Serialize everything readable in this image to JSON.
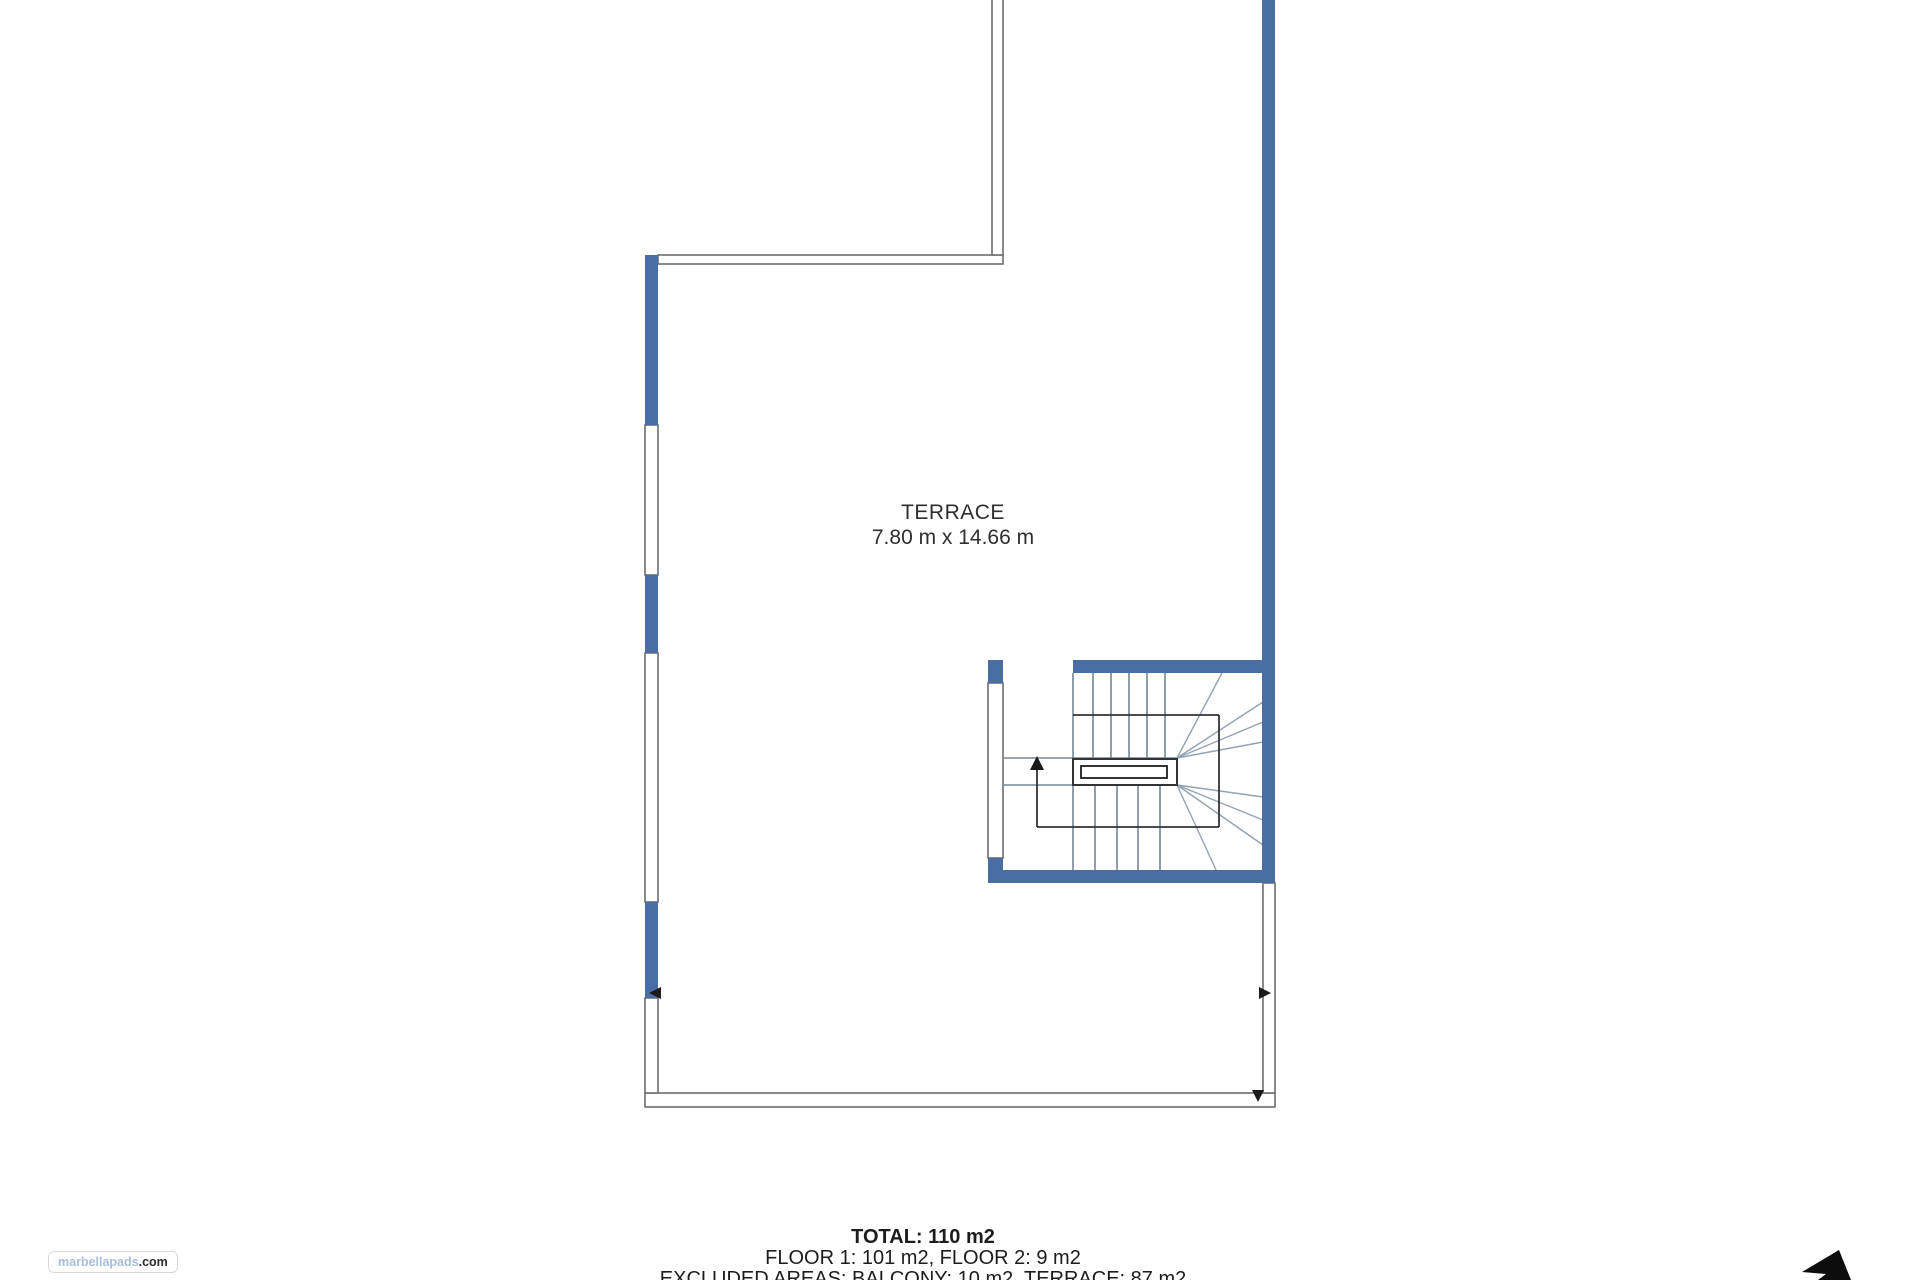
{
  "page": {
    "width": 1920,
    "height": 1280,
    "background": "#ffffff"
  },
  "room_label": {
    "name": "TERRACE",
    "dimensions": "7.80 m x 14.66 m",
    "x": 953,
    "y": 500
  },
  "summary": {
    "total": "TOTAL: 110 m2",
    "floors": "FLOOR 1: 101 m2, FLOOR 2: 9 m2",
    "excluded": "EXCLUDED AREAS: BALCONY: 10 m2, TERRACE: 87 m2",
    "x": 923,
    "y": 1227
  },
  "logo": {
    "brand": "marbellapads",
    "suffix": ".com",
    "brand_color": "#a7bdd9",
    "suffix_color": "#2b2b2b"
  },
  "colors": {
    "wall_blue": "#4a6da4",
    "thin_wall": "#6e6e6e",
    "stair_line": "#758597",
    "stair_fan": "#93a2b4",
    "rail": "#333333",
    "arrow": "#1a1a1a",
    "compass": "#0d0d0d"
  },
  "plan": {
    "walls_blue": [
      {
        "name": "left-wall-upper",
        "rect": [
          645,
          255,
          13,
          170
        ]
      },
      {
        "name": "left-wall-middle",
        "rect": [
          645,
          575,
          13,
          78
        ]
      },
      {
        "name": "left-wall-lower",
        "rect": [
          645,
          902,
          13,
          96
        ]
      },
      {
        "name": "right-wall",
        "rect": [
          1262,
          0,
          13,
          883
        ]
      },
      {
        "name": "stair-top-wall",
        "rect": [
          1073,
          660,
          189,
          13
        ]
      },
      {
        "name": "stair-left-top-block",
        "rect": [
          988,
          660,
          15,
          23
        ]
      },
      {
        "name": "stair-left-bottom-block",
        "rect": [
          988,
          858,
          15,
          25
        ]
      },
      {
        "name": "stair-bottom-wall",
        "rect": [
          1003,
          870,
          272,
          13
        ]
      }
    ],
    "thin_walls": [
      {
        "name": "top-balcony-wall-horizontal",
        "rect": [
          658,
          255,
          345,
          9
        ]
      },
      {
        "name": "top-balcony-wall-vertical",
        "rect": [
          992,
          -5,
          11,
          260
        ]
      },
      {
        "name": "bottom-terrace-wall",
        "rect": [
          645,
          1093,
          630,
          14
        ]
      },
      {
        "name": "right-terrace-wall-lower",
        "rect": [
          1263,
          883,
          12,
          210
        ]
      }
    ],
    "windows": [
      {
        "name": "left-window-1",
        "rect": [
          645,
          425,
          13,
          150
        ]
      },
      {
        "name": "left-window-2",
        "rect": [
          645,
          653,
          13,
          249
        ]
      },
      {
        "name": "left-window-3",
        "rect": [
          645,
          998,
          13,
          95
        ]
      },
      {
        "name": "stair-left-window",
        "rect": [
          988,
          683,
          15,
          175
        ]
      }
    ],
    "stair": {
      "flight_lines": [
        [
          1073,
          673,
          1073,
          759
        ],
        [
          1073,
          785,
          1073,
          872
        ],
        [
          1093,
          673,
          1093,
          758
        ],
        [
          1111,
          673,
          1111,
          758
        ],
        [
          1129,
          673,
          1129,
          758
        ],
        [
          1147,
          673,
          1147,
          758
        ],
        [
          1165,
          673,
          1165,
          758
        ],
        [
          1095,
          785,
          1095,
          872
        ],
        [
          1117,
          785,
          1117,
          872
        ],
        [
          1138,
          785,
          1138,
          872
        ],
        [
          1160,
          785,
          1160,
          872
        ],
        [
          1003,
          758,
          1177,
          758
        ],
        [
          1003,
          785,
          1177,
          785
        ]
      ],
      "fan_lines": [
        [
          1177,
          758,
          1222,
          673
        ],
        [
          1177,
          758,
          1263,
          702
        ],
        [
          1177,
          758,
          1263,
          722
        ],
        [
          1177,
          758,
          1263,
          742
        ],
        [
          1177,
          785,
          1217,
          872
        ],
        [
          1177,
          785,
          1263,
          845
        ],
        [
          1177,
          785,
          1263,
          820
        ],
        [
          1177,
          785,
          1263,
          797
        ]
      ],
      "boundary_lines": [
        [
          1073,
          715,
          1219,
          715
        ],
        [
          1219,
          715,
          1219,
          827
        ],
        [
          1219,
          827,
          1037,
          827
        ],
        [
          1037,
          827,
          1037,
          766
        ]
      ],
      "rail_outer": [
        1073,
        759,
        104,
        26
      ],
      "rail_inner": [
        1081,
        766,
        86,
        12
      ],
      "up_arrow_head": "1030,770 1044,770 1037,756"
    },
    "dim_arrows": [
      {
        "name": "dim-arrow-left",
        "points": "649,993 661,987 661,999"
      },
      {
        "name": "dim-arrow-right",
        "points": "1271,993 1259,987 1259,999"
      },
      {
        "name": "dim-arrow-down",
        "points": "1258,1102 1252,1090 1264,1090"
      }
    ],
    "compass_points": "1802,1272 1839,1250 1851,1280 1818,1280 1826,1274"
  }
}
